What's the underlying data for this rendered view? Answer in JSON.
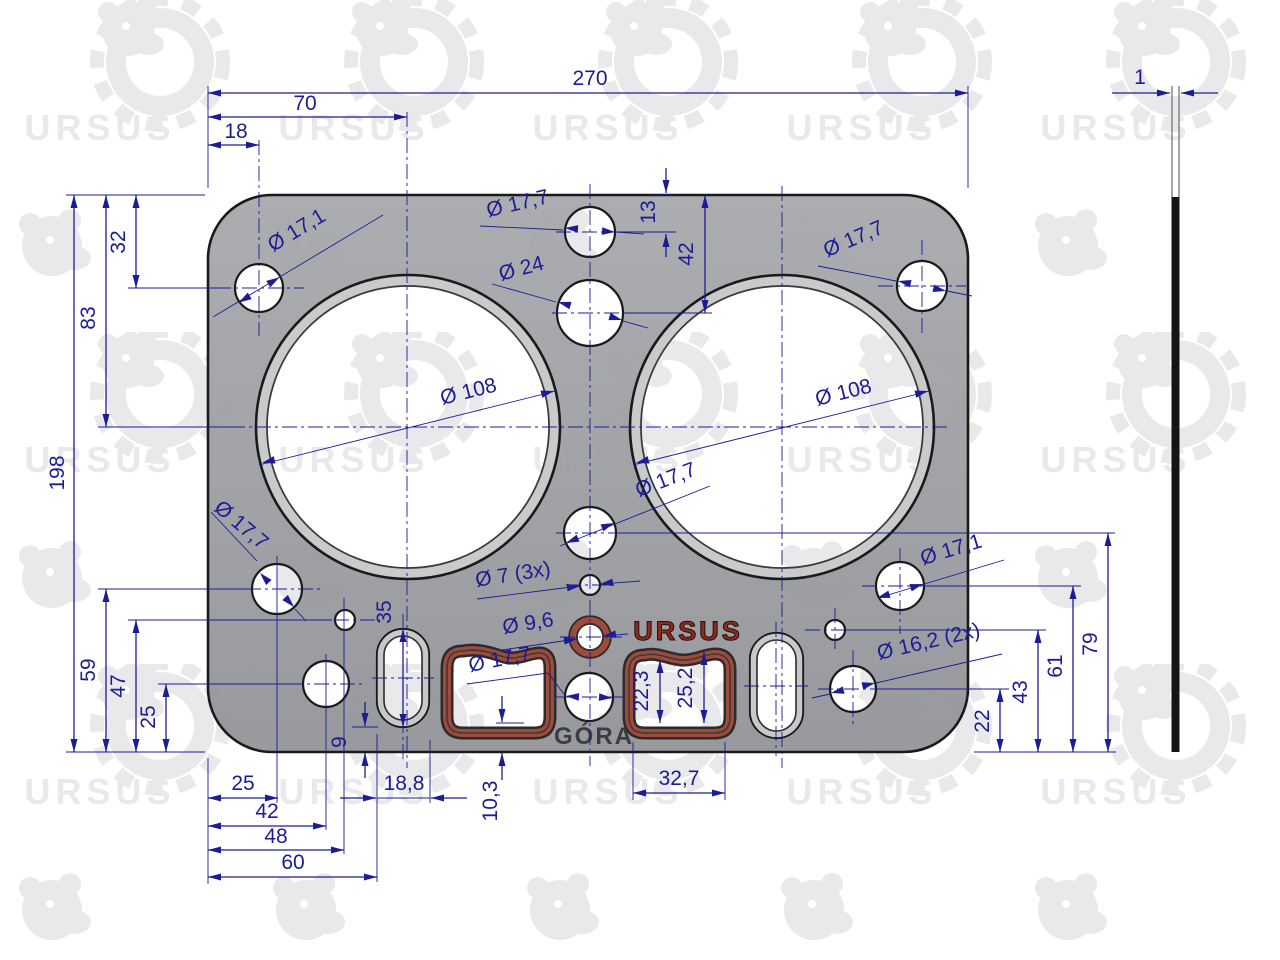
{
  "brand": {
    "watermark": "URSUS",
    "emboss": "URSUS"
  },
  "stamp": {
    "gora": "GÓRA"
  },
  "dims": {
    "w270": "270",
    "w70": "70",
    "w18": "18",
    "thickness": "1",
    "h32": "32",
    "h83": "83",
    "h198": "198",
    "h59": "59",
    "h47": "47",
    "h25": "25",
    "b25": "25",
    "b42": "42",
    "b48": "48",
    "b60": "60",
    "b18_8": "18,8",
    "b9": "9",
    "b35": "35",
    "b10_3": "10,3",
    "b32_7": "32,7",
    "b22_3": "22,3",
    "b25_2": "25,2",
    "r13": "13",
    "r42": "42",
    "r22": "22",
    "r43": "43",
    "r61": "61",
    "r79": "79"
  },
  "dia": {
    "top_left": "Ø 17,1",
    "top_center": "Ø 17,7",
    "d24": "Ø 24",
    "top_right": "Ø 17,7",
    "bore_left": "Ø 108",
    "bore_right": "Ø 108",
    "mid": "Ø 17,7",
    "d7_3x": "Ø 7 (3x)",
    "d9_6": "Ø 9,6",
    "bottom_left": "Ø 17,7",
    "passage": "Ø 17,7",
    "bottom_right": "Ø 17,1",
    "d16_2_2x": "Ø 16,2 (2x)"
  },
  "colors": {
    "dimension": "#1c1c94",
    "gasket_body": "#9b9c9f",
    "bore_ring": "#c9cacb",
    "seal_red": "#a04a3c",
    "emboss_red": "#8f2b1e",
    "watermark": "#e9e9ec"
  }
}
